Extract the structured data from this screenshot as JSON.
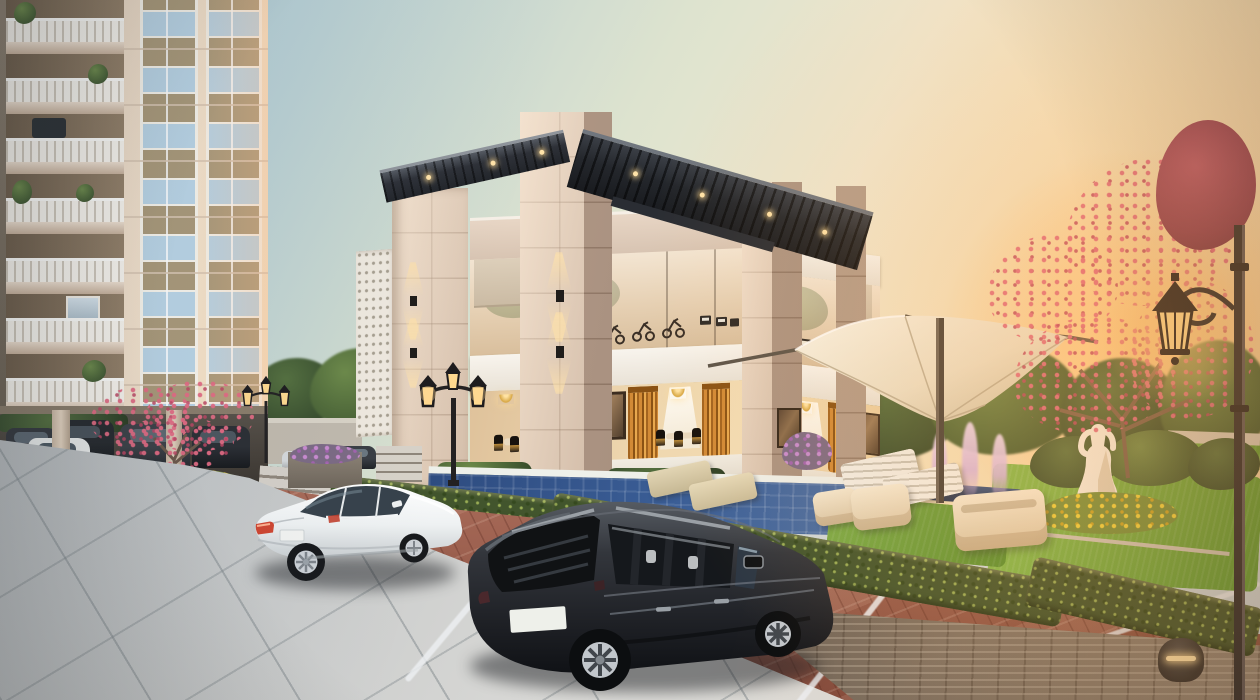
{
  "scene": {
    "description": "Sunset photorealistic 3D architectural rendering of a residential amenity clubhouse with swimming pool, landscaped garden, tensile canopy and parked cars beside a high-rise apartment tower",
    "time_of_day": "sunset",
    "render_style": "exterior visualization",
    "no_visible_text": true
  },
  "palette": {
    "sky_top_blue": "#9fc0d2",
    "sky_warm_cream": "#f0e7cf",
    "sun_glow_orange": "#ffc478",
    "facade_cream": "#f2e1cd",
    "facade_brown_panel": "#8f7b64",
    "window_glass_blue": "#b9d3e4",
    "clubhouse_stone": "#e4d1bf",
    "pergola_dark": "#2e3138",
    "glass_reflection_warm": "#f3e5d2",
    "curtain_gold": "#d28a36",
    "interior_warm_light": "#f3ddb5",
    "pool_blue": "#3a5d95",
    "lawn_green": "#74ad42",
    "hedge_green": "#42552d",
    "brick_paver_red": "#a2604f",
    "concrete_paving_gray": "#ced1d3",
    "canopy_fabric_cream": "#f2ead8",
    "fountain_water_purple": "#d4b0dc",
    "suv_charcoal": "#24262b",
    "sedan_white": "#f3f4f5",
    "lamp_glow_amber": "#ffd98f",
    "flower_pink": "#d4647a",
    "flower_yellow": "#f2d43e",
    "flower_purple": "#c98bd0",
    "statue_white": "#f6efe2",
    "retaining_wall_gray": "#8b7e70"
  },
  "objects": {
    "apartment_tower": {
      "position": "left",
      "balcony_floors_visible": 7,
      "window_columns": 2,
      "stilt_parking_cars": 5,
      "balcony_plants": true
    },
    "clubhouse": {
      "levels": 2,
      "upper_level_use": "gym with exercise bikes and treadmills",
      "lower_level_use": "dining lounge with gold curtains and chandeliers",
      "features": [
        "rooftop slatted pergola",
        "stone tile pillars",
        "perforated jali screen",
        "up-down wall sconces",
        "wall artwork"
      ]
    },
    "swimming_pool": {
      "location": "in front of clubhouse",
      "color": "deep blue"
    },
    "garden": {
      "canopy": "white tensile inverted umbrella on dark pole",
      "statue": "white seated female figure",
      "fountain_jets": 3,
      "lounge_chairs_white": 2,
      "lounge_chairs_tan": 2,
      "cream_sofas": 3,
      "flower_beds": [
        "yellow",
        "purple",
        "pink flowering trees"
      ],
      "lawn": true
    },
    "vehicles_foreground": [
      "white sedan parked",
      "dark charcoal SUV parked"
    ],
    "vehicles_background": [
      "white hatchback",
      "silver sedan",
      "dark sedan"
    ],
    "site_lighting": [
      "twin-lantern black lamp posts",
      "single-lantern tall pole lamp",
      "dome bollard light"
    ],
    "paving": {
      "driveway": "large gray concrete slabs",
      "parking": "red clay brick pavers with white stall lines"
    },
    "license_plate_suv": "",
    "license_plate_sedan": ""
  }
}
